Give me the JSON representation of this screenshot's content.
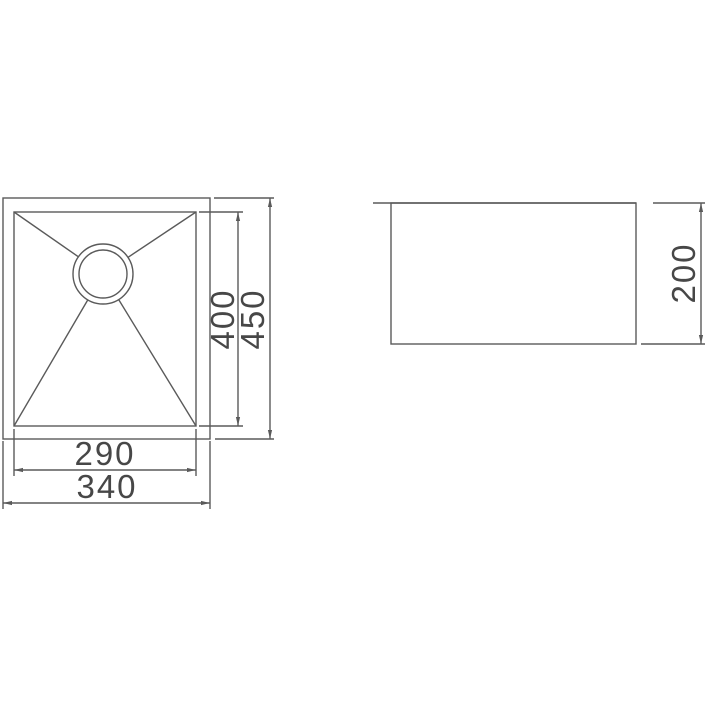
{
  "drawing": {
    "type": "sink-technical-drawing",
    "colors": {
      "background": "#ffffff",
      "line": "#5a5a5a",
      "text": "#474747"
    },
    "top_view": {
      "dimensions": {
        "inner_width": "290",
        "outer_width": "340",
        "inner_length": "400",
        "outer_length": "450"
      }
    },
    "side_view": {
      "dimensions": {
        "depth": "200"
      }
    }
  }
}
